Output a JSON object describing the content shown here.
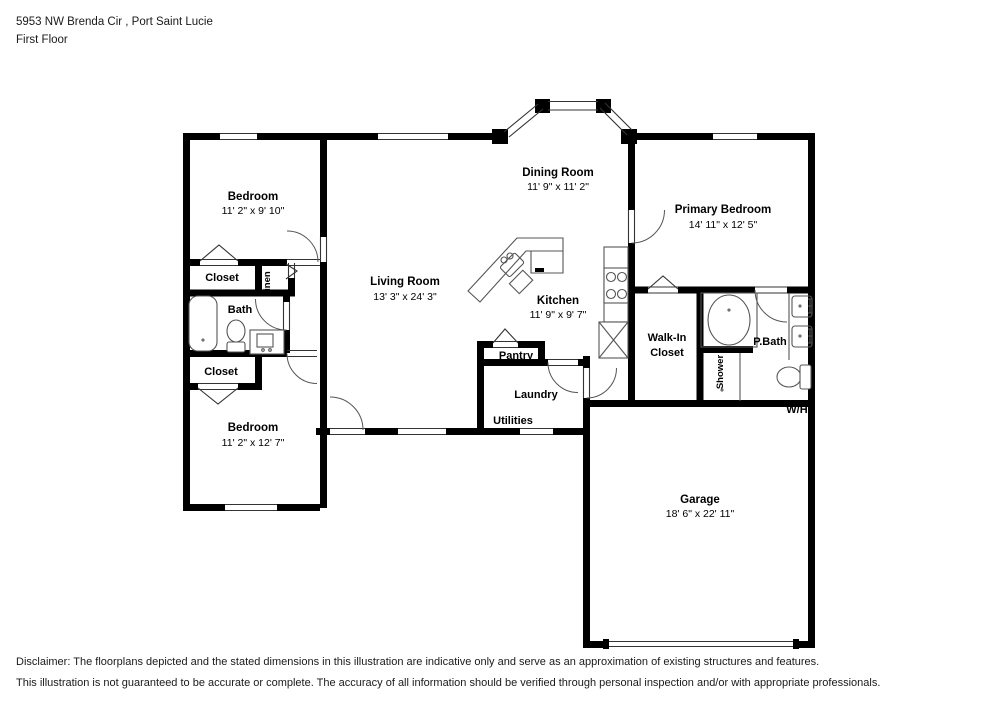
{
  "header": {
    "address": "5953 NW Brenda Cir , Port Saint Lucie",
    "floor_label": "First Floor"
  },
  "rooms": {
    "bedroom_top": {
      "name": "Bedroom",
      "dims": "11' 2\" x 9' 10\""
    },
    "bedroom_bottom": {
      "name": "Bedroom",
      "dims": "11' 2\" x 12' 7\""
    },
    "living_room": {
      "name": "Living Room",
      "dims": "13' 3\" x 24' 3\""
    },
    "dining_room": {
      "name": "Dining Room",
      "dims": "11' 9\" x 11' 2\""
    },
    "kitchen": {
      "name": "Kitchen",
      "dims": "11' 9\" x 9' 7\""
    },
    "primary_bedroom": {
      "name": "Primary Bedroom",
      "dims": "14' 11\" x 12' 5\""
    },
    "garage": {
      "name": "Garage",
      "dims": "18' 6\" x 22' 11\""
    },
    "walk_in_closet": {
      "line1": "Walk-In",
      "line2": "Closet"
    },
    "p_bath": {
      "name": "P.Bath"
    },
    "bath": {
      "name": "Bath"
    },
    "closet_upper": {
      "name": "Closet"
    },
    "closet_lower": {
      "name": "Closet"
    },
    "linen": {
      "name": "Linen"
    },
    "pantry": {
      "name": "Pantry"
    },
    "laundry": {
      "name": "Laundry"
    },
    "utilities": {
      "name": "Utilities"
    },
    "shower": {
      "name": "Shower"
    },
    "water_heater": {
      "name": "W/H"
    }
  },
  "disclaimer": {
    "line1": "Disclaimer: The floorplans depicted and the stated dimensions in this illustration are indicative only and serve as an approximation of existing structures and features.",
    "line2": "This illustration is not guaranteed to be accurate or complete. The accuracy of all information should be verified through personal inspection and/or with appropriate professionals."
  },
  "colors": {
    "wall": "#000000",
    "fixture_line": "#555555",
    "background": "#ffffff"
  }
}
